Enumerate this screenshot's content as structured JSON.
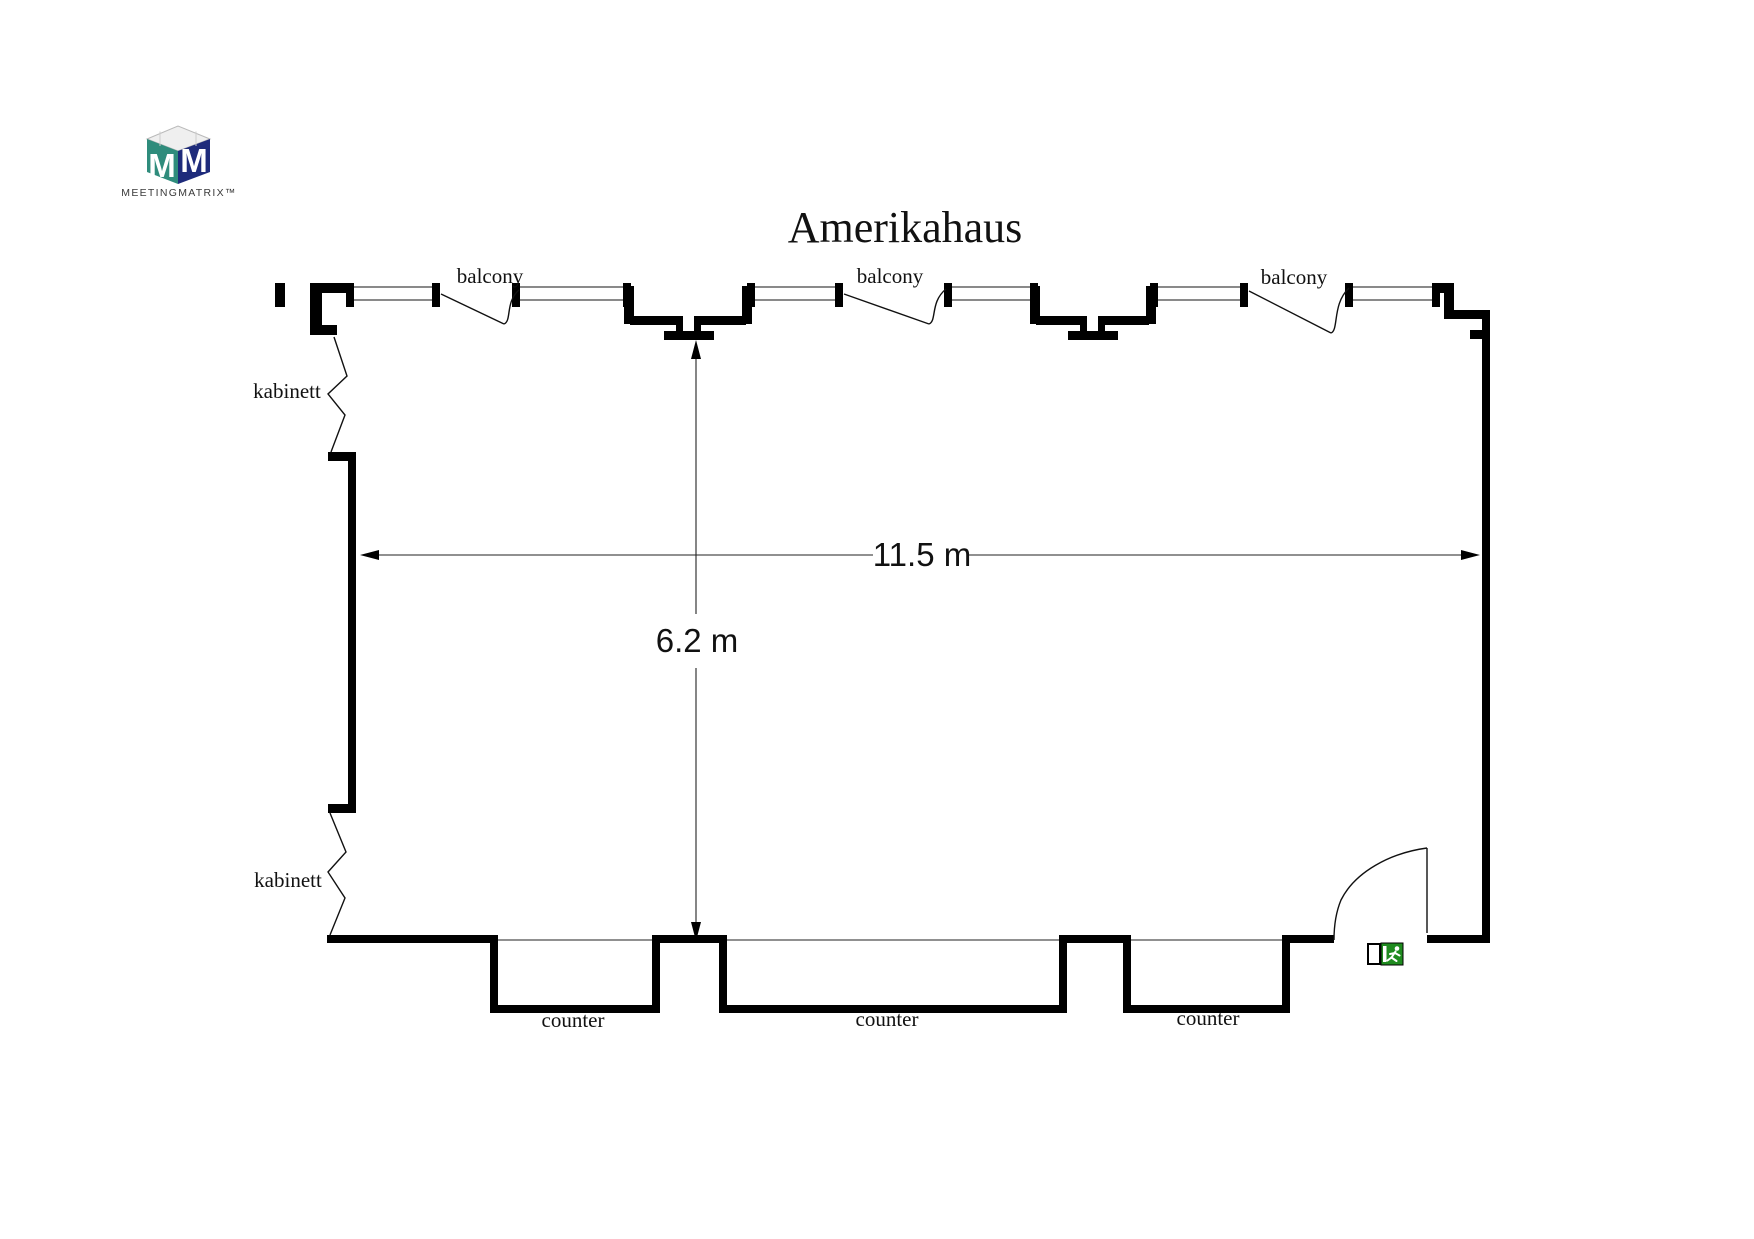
{
  "title": "Amerikahaus",
  "logo": {
    "brand": "MEETINGMATRIX™",
    "monogram_left": "M",
    "monogram_right": "M",
    "teal": "#2F8C7C",
    "navy": "#1E2B7B"
  },
  "dimensions": {
    "width": "11.5 m",
    "height": "6.2 m"
  },
  "labels": {
    "balcony": [
      "balcony",
      "balcony",
      "balcony"
    ],
    "kabinett": [
      "kabinett",
      "kabinett"
    ],
    "counter": [
      "counter",
      "counter",
      "counter"
    ]
  },
  "exit_sign": {
    "green": "#1F8B1F"
  }
}
